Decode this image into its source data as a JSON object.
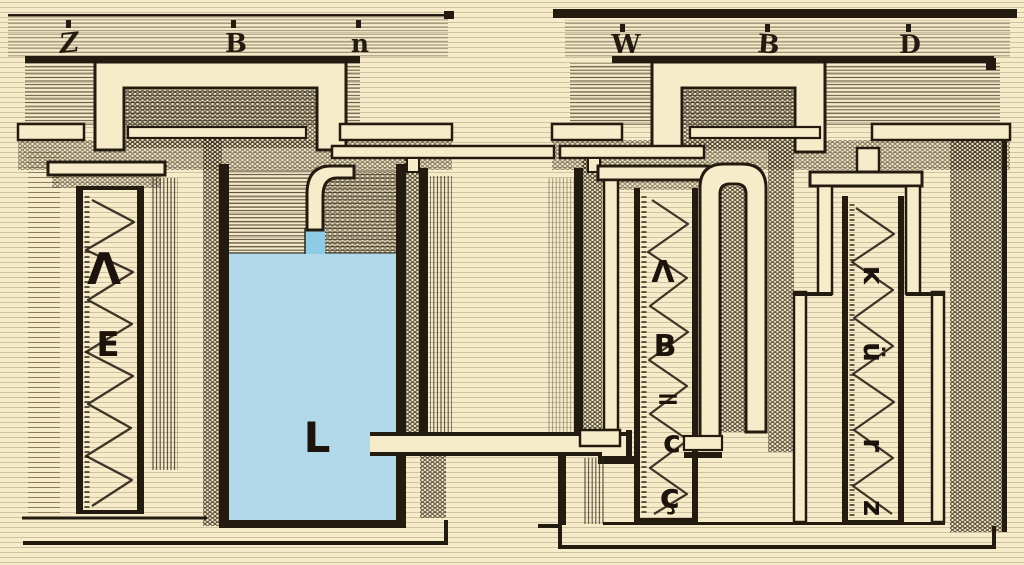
{
  "diagram": {
    "description": "Antique engraving-style technical diagram: spring cylinders, a blue liquid reservoir and connecting pipes",
    "colors": {
      "background": "#f6ecca",
      "ink": "#241b10",
      "water": "#b2d9ea",
      "water_inlet": "#8ecbe4"
    },
    "left_beam": {
      "labels": [
        "Z",
        "B",
        "n"
      ]
    },
    "right_beam": {
      "labels": [
        "W",
        "B",
        "D"
      ]
    },
    "left_cylinder": {
      "labels": [
        "Λ",
        "E"
      ]
    },
    "reservoir": {
      "label": "L"
    },
    "center_cylinder": {
      "labels": [
        "Λ",
        "B",
        "=",
        "c",
        "ç"
      ]
    },
    "right_cylinder": {
      "labels": [
        "ĸ",
        "ü",
        "r",
        "z"
      ]
    }
  }
}
